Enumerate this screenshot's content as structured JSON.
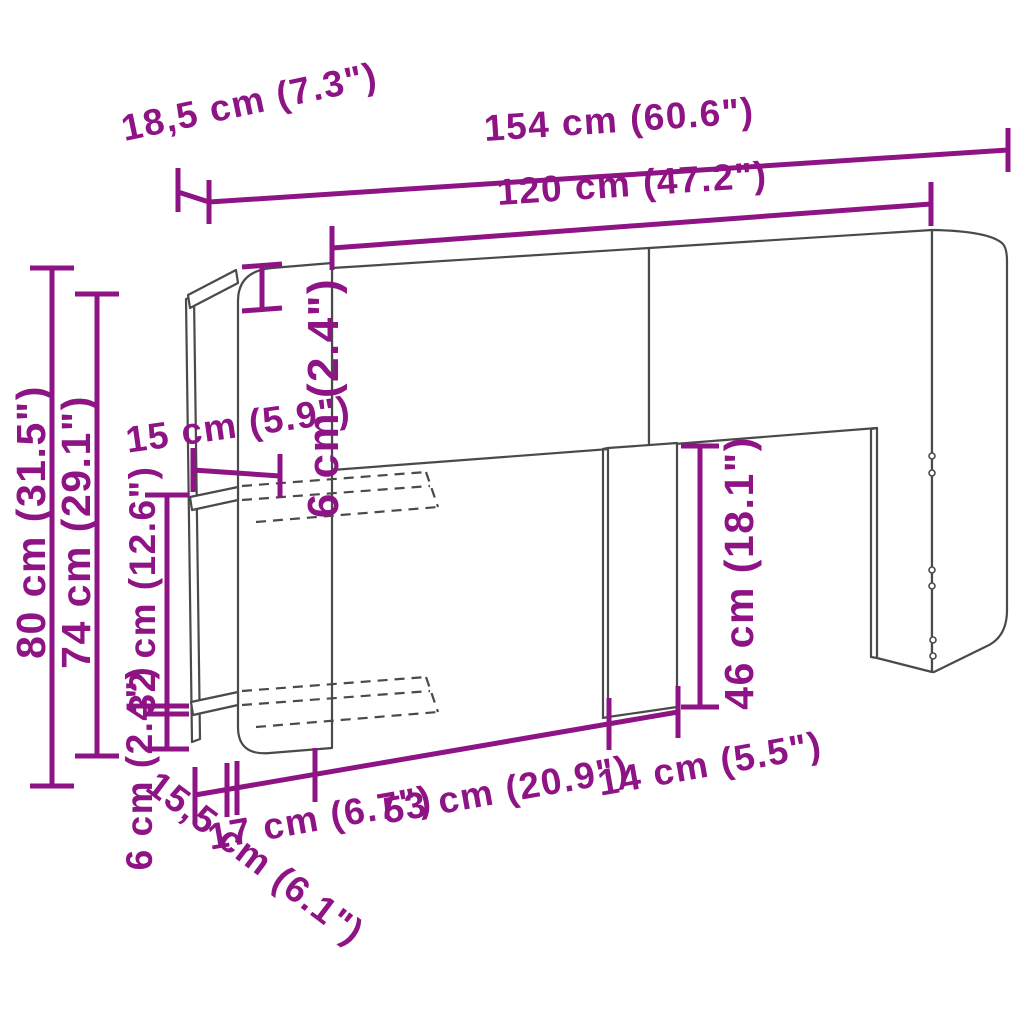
{
  "diagram": {
    "type": "furniture-dimension-diagram",
    "subject": "headboard with storage shelf unit, line drawing with measurements",
    "colors": {
      "dimension_accent": "#8e1385",
      "outline": "#4a4a4a",
      "background": "#ffffff"
    },
    "parts": [
      "headboard-left-panel",
      "headboard-right-panel",
      "side-shelf-unit",
      "middle-leg",
      "right-leg",
      "right-side-panel",
      "hidden-shelves"
    ],
    "dimensions": [
      {
        "id": "total-width",
        "label": "154 cm (60.6\")"
      },
      {
        "id": "headboard-width",
        "label": "120 cm (47.2\")"
      },
      {
        "id": "side-unit-depth",
        "label": "18,5 cm (7.3\")"
      },
      {
        "id": "total-height",
        "label": "80 cm (31.5\")"
      },
      {
        "id": "side-unit-height",
        "label": "74 cm (29.1\")"
      },
      {
        "id": "shelf-spacing",
        "label": "32 cm (12.6\")"
      },
      {
        "id": "top-panel-height",
        "label": "6 cm (2.4\")"
      },
      {
        "id": "shelf-inner-depth",
        "label": "15 cm (5.9\")"
      },
      {
        "id": "leg-height",
        "label": "46 cm (18.1\")"
      },
      {
        "id": "bottom-clearance",
        "label": "6 cm (2.4\")"
      },
      {
        "id": "base-segment-17",
        "label": "17 cm (6.7\")"
      },
      {
        "id": "base-segment-53",
        "label": "53 cm (20.9\")"
      },
      {
        "id": "leg-width",
        "label": "14 cm (5.5\")"
      },
      {
        "id": "base-depth",
        "label": "15,5 cm (6.1\")"
      }
    ]
  }
}
